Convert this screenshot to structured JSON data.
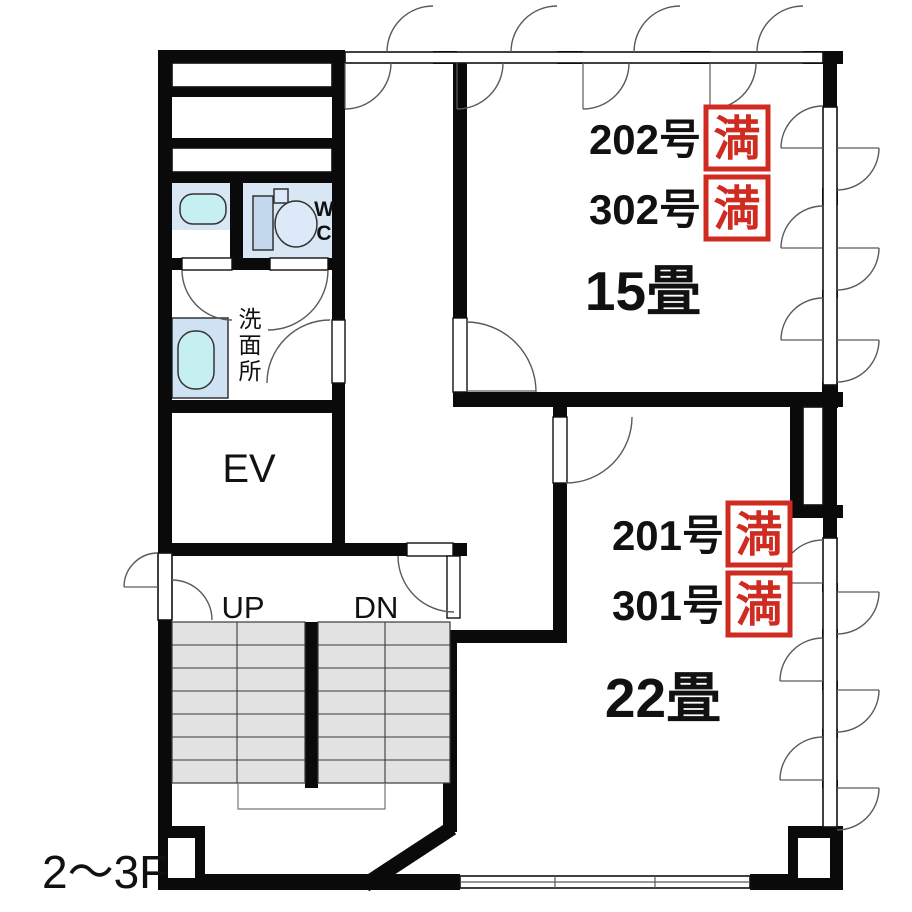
{
  "plan": {
    "floor_label": "2～3F",
    "rooms": {
      "upper": {
        "units": [
          {
            "name": "202号",
            "status": "満"
          },
          {
            "name": "302号",
            "status": "満"
          }
        ],
        "size": "15畳"
      },
      "lower": {
        "units": [
          {
            "name": "201号",
            "status": "満"
          },
          {
            "name": "301号",
            "status": "満"
          }
        ],
        "size": "22畳"
      }
    },
    "elevator_label": "EV",
    "stairs": {
      "up": "UP",
      "down": "DN"
    },
    "toilet": {
      "chars": [
        "W",
        "C"
      ]
    },
    "washroom": {
      "chars": [
        "洗",
        "面",
        "所"
      ]
    },
    "colors": {
      "wall": "#0a0a0a",
      "badge_red": "#cf2b20",
      "room_blue": "#d9e7f5",
      "fixture_cyan": "#c6eff2",
      "tank_blue": "#c3d7ed",
      "washer_blue": "#cfe2f3",
      "step_gray": "#e2e2e2"
    }
  }
}
